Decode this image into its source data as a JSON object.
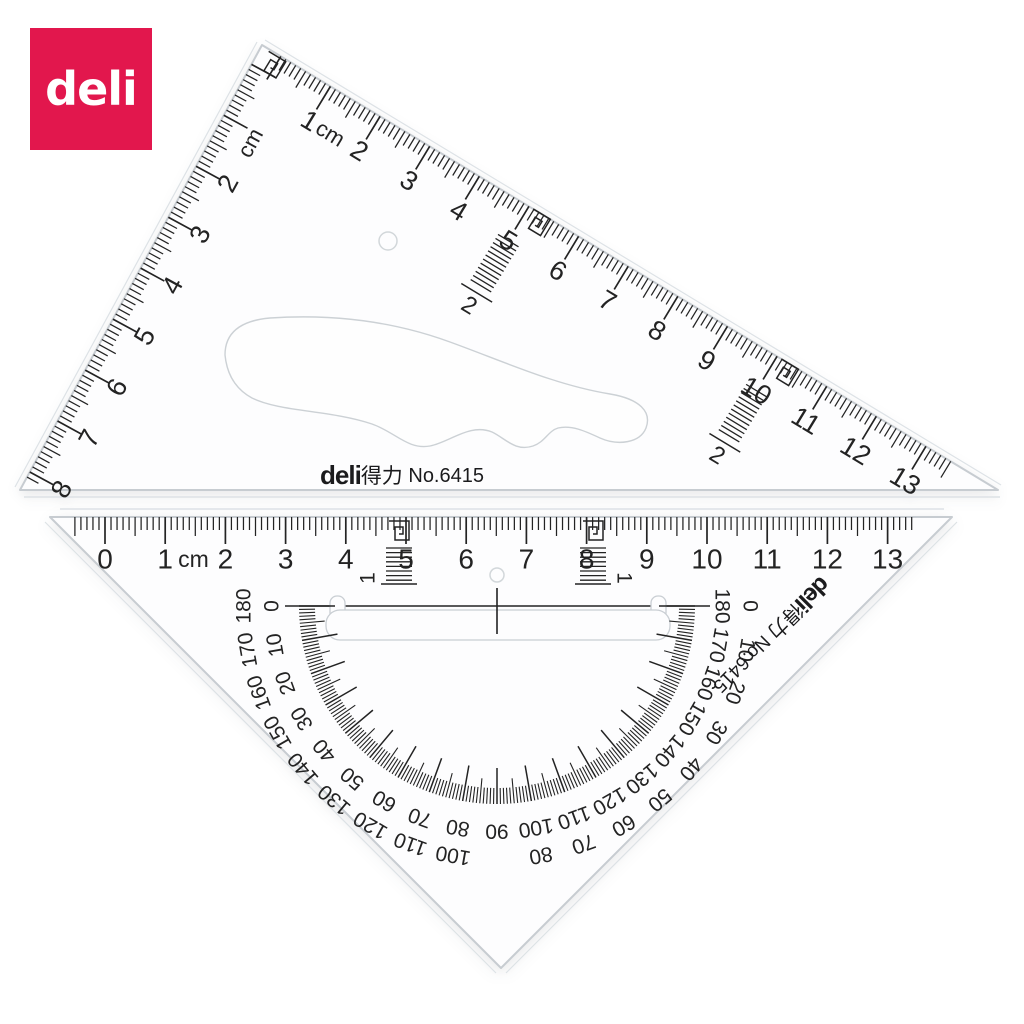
{
  "logo": {
    "text": "deli",
    "bg_color": "#E2174D",
    "text_color": "#FFFFFF"
  },
  "colors": {
    "tick": "#232323",
    "edge": "#C7CCD1",
    "bevel": "#DDE2E6",
    "plastic": "#FDFDFE",
    "logo_red": "#E2174D"
  },
  "brand": {
    "logo_text": "deli",
    "cn_text": "得力",
    "model_text": "No.6415"
  },
  "top_triangle": {
    "hyp_scale": {
      "unit": "cm",
      "numbers": [
        "1",
        "2",
        "3",
        "4",
        "5",
        "6",
        "7",
        "8",
        "9",
        "10",
        "11",
        "12",
        "13"
      ]
    },
    "left_scale": {
      "unit": "cm",
      "numbers": [
        "2",
        "3",
        "4",
        "5",
        "6",
        "7",
        "8"
      ]
    },
    "mini_scale_labels": [
      "2",
      "2"
    ]
  },
  "bottom_triangle": {
    "top_scale": {
      "unit": "cm",
      "numbers": [
        "0",
        "1",
        "2",
        "3",
        "4",
        "5",
        "6",
        "7",
        "8",
        "9",
        "10",
        "11",
        "12",
        "13"
      ]
    },
    "mini_scale_labels": [
      "1",
      "1"
    ],
    "protractor": {
      "outer_ring": [
        "180",
        "170",
        "160",
        "150",
        "140",
        "130",
        "120",
        "110",
        "100",
        "90",
        "80",
        "70",
        "60",
        "50",
        "40",
        "30",
        "20",
        "10",
        "0"
      ],
      "inner_ring": [
        "0",
        "10",
        "20",
        "30",
        "40",
        "50",
        "60",
        "70",
        "80",
        "90",
        "100",
        "110",
        "120",
        "130",
        "140",
        "150",
        "160",
        "170",
        "180"
      ],
      "center_label": "90"
    }
  }
}
